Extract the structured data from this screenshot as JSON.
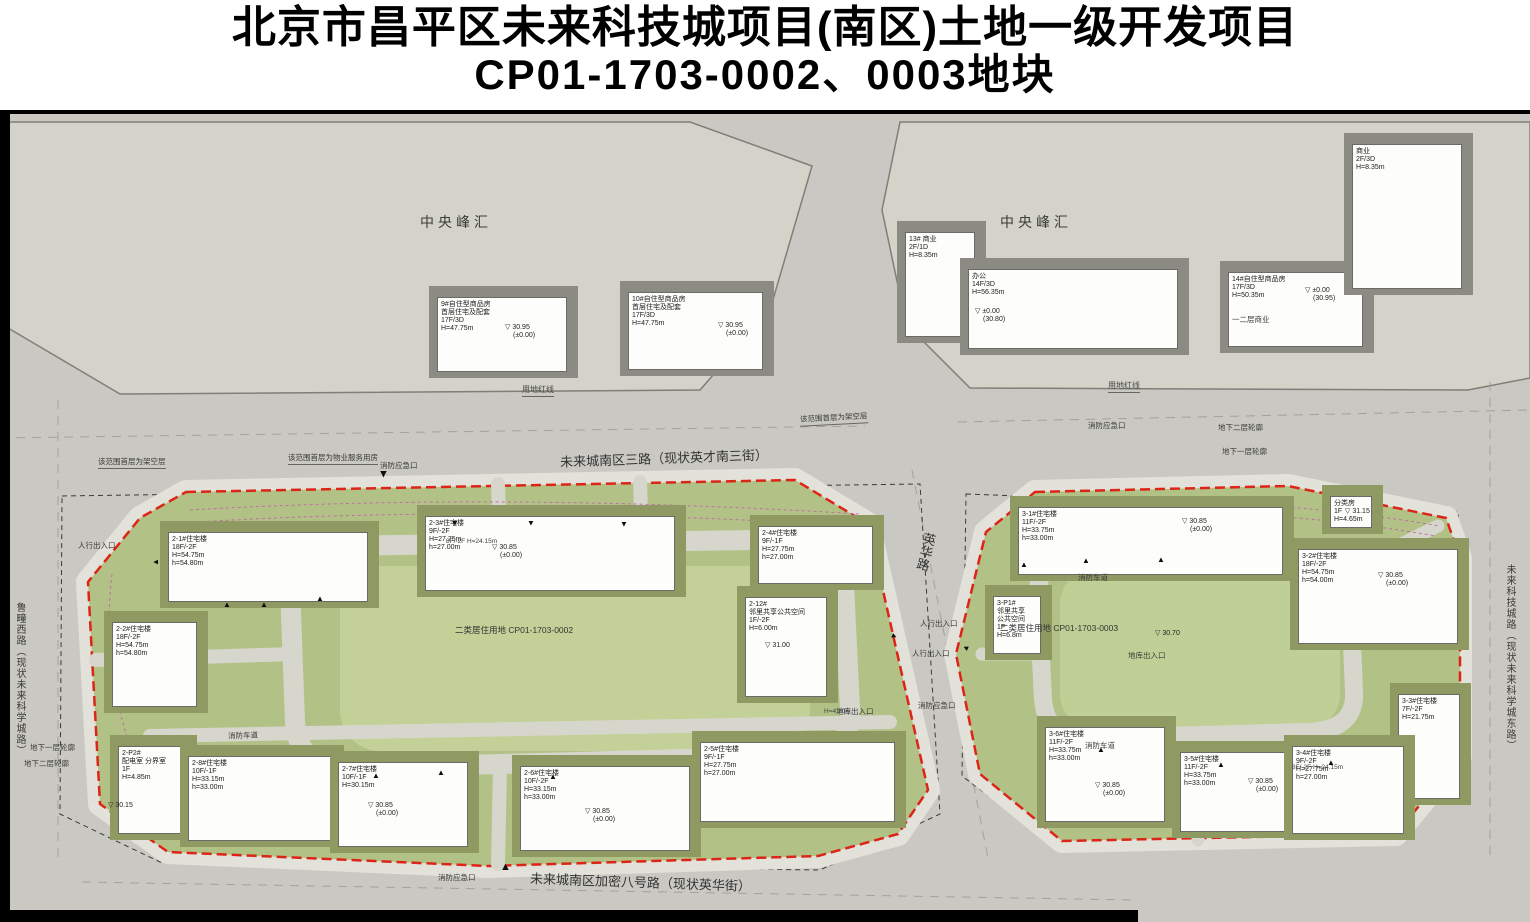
{
  "title": {
    "line1": "北京市昌平区未来科技城项目(南区)土地一级开发项目",
    "line2": "CP01-1703-0002、0003地块"
  },
  "colors": {
    "road_gray": "#c9c8c2",
    "block_gray": "#d3d3ca",
    "parcel_green": "#b2c286",
    "lawn_green": "#c3d199",
    "building_white": "#fdfdfb",
    "shadow_olive": "#8e9a62",
    "red_boundary": "#dd2517",
    "pink_dashed": "#c05aaa",
    "title_black": "#000000"
  },
  "plan": {
    "buildings": [
      {
        "x": 437,
        "y": 183,
        "w": 130,
        "h": 75,
        "zone": "off",
        "lines": [
          "9#自住型商品房",
          "首层住宅及配套",
          "17F/3D",
          "H=47.75m"
        ]
      },
      {
        "x": 628,
        "y": 178,
        "w": 135,
        "h": 78,
        "zone": "off",
        "lines": [
          "10#自住型商品房",
          "首层住宅及配套",
          "17F/3D",
          "H=47.75m"
        ]
      },
      {
        "x": 905,
        "y": 118,
        "w": 70,
        "h": 105,
        "zone": "off",
        "lines": [
          "13#  商业",
          "2F/1D",
          "H=8.35m"
        ]
      },
      {
        "x": 968,
        "y": 155,
        "w": 210,
        "h": 80,
        "zone": "off",
        "lines": [
          "办公",
          "14F/3D",
          "H=56.35m"
        ]
      },
      {
        "x": 1228,
        "y": 158,
        "w": 135,
        "h": 75,
        "zone": "off",
        "lines": [
          "14#自住型商品房",
          "17F/3D",
          "H=50.35m"
        ]
      },
      {
        "x": 1352,
        "y": 30,
        "w": 110,
        "h": 145,
        "zone": "off",
        "lines": [
          "商业",
          "2F/3D",
          "H=8.35m"
        ]
      },
      {
        "x": 168,
        "y": 418,
        "w": 200,
        "h": 70,
        "zone": "site",
        "lines": [
          "2-1#住宅楼",
          "18F/-2F",
          "H=54.75m",
          "h=54.80m"
        ]
      },
      {
        "x": 425,
        "y": 402,
        "w": 250,
        "h": 75,
        "zone": "site",
        "lines": [
          "2-3#住宅楼",
          "9F/-2F",
          "H=27.75m",
          "h=27.00m"
        ]
      },
      {
        "x": 758,
        "y": 412,
        "w": 115,
        "h": 58,
        "zone": "site",
        "lines": [
          "2-4#住宅楼",
          "9F/-1F",
          "H=27.75m",
          "h=27.00m"
        ]
      },
      {
        "x": 112,
        "y": 508,
        "w": 85,
        "h": 85,
        "zone": "site",
        "lines": [
          "2-2#住宅楼",
          "18F/-2F",
          "H=54.75m",
          "h=54.80m"
        ]
      },
      {
        "x": 745,
        "y": 483,
        "w": 82,
        "h": 100,
        "zone": "site",
        "lines": [
          "2-12#",
          "邻里共享公共空间",
          "1F/-2F",
          "H=6.00m"
        ]
      },
      {
        "x": 118,
        "y": 632,
        "w": 68,
        "h": 88,
        "zone": "site",
        "lines": [
          "2-P2#",
          "配电室 分界室",
          "1F",
          "H=4.85m"
        ]
      },
      {
        "x": 188,
        "y": 642,
        "w": 145,
        "h": 85,
        "zone": "site",
        "lines": [
          "2-8#住宅楼",
          "10F/-1F",
          "H=33.15m",
          "h=33.00m"
        ]
      },
      {
        "x": 338,
        "y": 648,
        "w": 130,
        "h": 85,
        "zone": "site",
        "lines": [
          "2-7#住宅楼",
          "10F/-1F",
          "H=30.15m"
        ]
      },
      {
        "x": 520,
        "y": 652,
        "w": 170,
        "h": 85,
        "zone": "site",
        "lines": [
          "2-6#住宅楼",
          "10F/-2F",
          "H=33.15m",
          "h=33.00m"
        ]
      },
      {
        "x": 700,
        "y": 628,
        "w": 195,
        "h": 80,
        "zone": "site",
        "lines": [
          "2-5#住宅楼",
          "9F/-1F",
          "H=27.75m",
          "h=27.00m"
        ]
      },
      {
        "x": 1018,
        "y": 393,
        "w": 265,
        "h": 68,
        "zone": "site",
        "lines": [
          "3-1#住宅楼",
          "11F/-2F",
          "H=33.75m",
          "h=33.00m"
        ]
      },
      {
        "x": 1298,
        "y": 435,
        "w": 160,
        "h": 95,
        "zone": "site",
        "lines": [
          "3-2#住宅楼",
          "18F/-2F",
          "H=54.75m",
          "h=54.00m"
        ]
      },
      {
        "x": 1398,
        "y": 580,
        "w": 62,
        "h": 105,
        "zone": "site",
        "lines": [
          "3-3#住宅楼",
          "7F/-2F",
          "H=21.75m"
        ]
      },
      {
        "x": 1045,
        "y": 613,
        "w": 120,
        "h": 95,
        "zone": "site",
        "lines": [
          "3-6#住宅楼",
          "11F/-2F",
          "H=33.75m",
          "h=33.00m"
        ]
      },
      {
        "x": 1180,
        "y": 638,
        "w": 125,
        "h": 80,
        "zone": "site",
        "lines": [
          "3-5#住宅楼",
          "11F/-2F",
          "H=33.75m",
          "h=33.00m"
        ]
      },
      {
        "x": 1292,
        "y": 632,
        "w": 112,
        "h": 88,
        "zone": "site",
        "lines": [
          "3-4#住宅楼",
          "9F/-2F",
          "H=27.75m",
          "h=27.00m"
        ]
      },
      {
        "x": 993,
        "y": 482,
        "w": 48,
        "h": 58,
        "zone": "site",
        "lines": [
          "3-P1#",
          "邻里共享",
          "公共空间",
          "1F",
          "H=6.8m"
        ]
      },
      {
        "x": 1330,
        "y": 382,
        "w": 42,
        "h": 32,
        "zone": "site",
        "lines": [
          "分类房",
          "1F",
          "H=4.65m"
        ]
      }
    ],
    "annotations": [
      {
        "t": "中央峰汇",
        "x": 420,
        "y": 98,
        "cls": "big"
      },
      {
        "t": "中央峰汇",
        "x": 1000,
        "y": 98,
        "cls": "big"
      },
      {
        "t": "用地红线",
        "x": 522,
        "y": 270,
        "cls": "t7 leader"
      },
      {
        "t": "用地红线",
        "x": 1108,
        "y": 266,
        "cls": "t7 leader"
      },
      {
        "t": "未来城南区三路（现状英才南三街）",
        "x": 560,
        "y": 334,
        "cls": "road",
        "rot": -2
      },
      {
        "t": "未来城南区加密八号路（现状英华街）",
        "x": 530,
        "y": 758,
        "cls": "road",
        "rot": 2
      },
      {
        "t": "英华路",
        "x": 916,
        "y": 418,
        "cls": "road vert",
        "rot": 14
      },
      {
        "t": "鲁疃西路（现状未来科学城路）",
        "x": 12,
        "y": 488,
        "cls": "vert edge"
      },
      {
        "t": "未来科技城路（现状未来科学城东路）",
        "x": 1502,
        "y": 450,
        "cls": "vert edge"
      },
      {
        "t": "该范围首层为架空层",
        "x": 98,
        "y": 342,
        "cls": "small leader"
      },
      {
        "t": "该范围首层为物业服务用房",
        "x": 288,
        "y": 338,
        "cls": "small leader"
      },
      {
        "t": "该范围首层为架空层",
        "x": 800,
        "y": 298,
        "cls": "small leader",
        "rot": -3
      },
      {
        "t": "消防应急口",
        "x": 380,
        "y": 346,
        "cls": "small"
      },
      {
        "t": "消防应急口",
        "x": 1088,
        "y": 306,
        "cls": "small"
      },
      {
        "t": "消防应急口",
        "x": 918,
        "y": 586,
        "cls": "small"
      },
      {
        "t": "消防应急口",
        "x": 438,
        "y": 758,
        "cls": "small"
      },
      {
        "t": "人行出入口",
        "x": 78,
        "y": 426,
        "cls": "small"
      },
      {
        "t": "人行出入口",
        "x": 920,
        "y": 504,
        "cls": "small"
      },
      {
        "t": "人行出入口",
        "x": 912,
        "y": 534,
        "cls": "small"
      },
      {
        "t": "地库出入口",
        "x": 836,
        "y": 592,
        "cls": "small"
      },
      {
        "t": "地库出入口",
        "x": 1128,
        "y": 536,
        "cls": "small"
      },
      {
        "t": "消防车道",
        "x": 228,
        "y": 616,
        "cls": "small",
        "rot": -2
      },
      {
        "t": "消防车道",
        "x": 1078,
        "y": 458,
        "cls": "small"
      },
      {
        "t": "消防车道",
        "x": 1085,
        "y": 626,
        "cls": "small"
      },
      {
        "t": "地下一层轮廓",
        "x": 30,
        "y": 628,
        "cls": "small"
      },
      {
        "t": "地下二层轮廓",
        "x": 24,
        "y": 644,
        "cls": "small"
      },
      {
        "t": "地下二层轮廓",
        "x": 1218,
        "y": 308,
        "cls": "small"
      },
      {
        "t": "地下一层轮廓",
        "x": 1222,
        "y": 332,
        "cls": "small"
      },
      {
        "t": "一二层商业",
        "x": 1232,
        "y": 200,
        "cls": "small"
      },
      {
        "t": "二类居住用地 CP01-1703-0002",
        "x": 455,
        "y": 510,
        "cls": "lu"
      },
      {
        "t": "二类居住用地 CP01-1703-0003",
        "x": 1000,
        "y": 508,
        "cls": "lu"
      },
      {
        "t": "8F/-2F H=24.15m",
        "x": 446,
        "y": 424,
        "cls": "tiny"
      },
      {
        "t": "8F/-2F H=24.15m",
        "x": 1292,
        "y": 650,
        "cls": "tiny"
      },
      {
        "t": "H=4.20m",
        "x": 824,
        "y": 594,
        "cls": "tiny"
      }
    ],
    "elevations": [
      {
        "v": "30.95",
        "s": "(±0.00)",
        "x": 505,
        "y": 210
      },
      {
        "v": "30.95",
        "s": "(±0.00)",
        "x": 718,
        "y": 208
      },
      {
        "v": "±0.00",
        "s": "(30.80)",
        "x": 975,
        "y": 194
      },
      {
        "v": "±0.00",
        "s": "(30.95)",
        "x": 1305,
        "y": 173
      },
      {
        "v": "30.85",
        "s": "(±0.00)",
        "x": 492,
        "y": 430
      },
      {
        "v": "30.85",
        "s": "(±0.00)",
        "x": 368,
        "y": 688
      },
      {
        "v": "30.85",
        "s": "(±0.00)",
        "x": 585,
        "y": 694
      },
      {
        "v": "30.85",
        "s": "(±0.00)",
        "x": 1182,
        "y": 404
      },
      {
        "v": "30.85",
        "s": "(±0.00)",
        "x": 1378,
        "y": 458
      },
      {
        "v": "30.85",
        "s": "(±0.00)",
        "x": 1095,
        "y": 668
      },
      {
        "v": "30.85",
        "s": "(±0.00)",
        "x": 1248,
        "y": 664
      },
      {
        "v": "31.00",
        "s": "",
        "x": 765,
        "y": 528
      },
      {
        "v": "30.15",
        "s": "",
        "x": 108,
        "y": 688
      },
      {
        "v": "30.70",
        "s": "",
        "x": 1155,
        "y": 516
      },
      {
        "v": "31.15",
        "s": "",
        "x": 1345,
        "y": 394
      }
    ],
    "arrows": [
      {
        "x": 451,
        "y": 405,
        "rot": 180
      },
      {
        "x": 527,
        "y": 405,
        "rot": 180
      },
      {
        "x": 620,
        "y": 406,
        "rot": 180
      },
      {
        "x": 378,
        "y": 354,
        "rot": 180,
        "big": true
      },
      {
        "x": 500,
        "y": 748,
        "rot": 0,
        "big": true
      },
      {
        "x": 223,
        "y": 487,
        "rot": 0
      },
      {
        "x": 260,
        "y": 487,
        "rot": 0
      },
      {
        "x": 316,
        "y": 481,
        "rot": 0
      },
      {
        "x": 1020,
        "y": 447,
        "rot": 0
      },
      {
        "x": 1082,
        "y": 443,
        "rot": 0
      },
      {
        "x": 1157,
        "y": 442,
        "rot": 0
      },
      {
        "x": 372,
        "y": 658,
        "rot": 0
      },
      {
        "x": 437,
        "y": 655,
        "rot": 0
      },
      {
        "x": 549,
        "y": 659,
        "rot": 0
      },
      {
        "x": 1097,
        "y": 632,
        "rot": 0
      },
      {
        "x": 1217,
        "y": 647,
        "rot": 0
      },
      {
        "x": 1327,
        "y": 645,
        "rot": 0
      },
      {
        "x": 152,
        "y": 444,
        "rot": -90
      },
      {
        "x": 890,
        "y": 518,
        "rot": 115
      },
      {
        "x": 962,
        "y": 530,
        "rot": -65
      }
    ]
  }
}
